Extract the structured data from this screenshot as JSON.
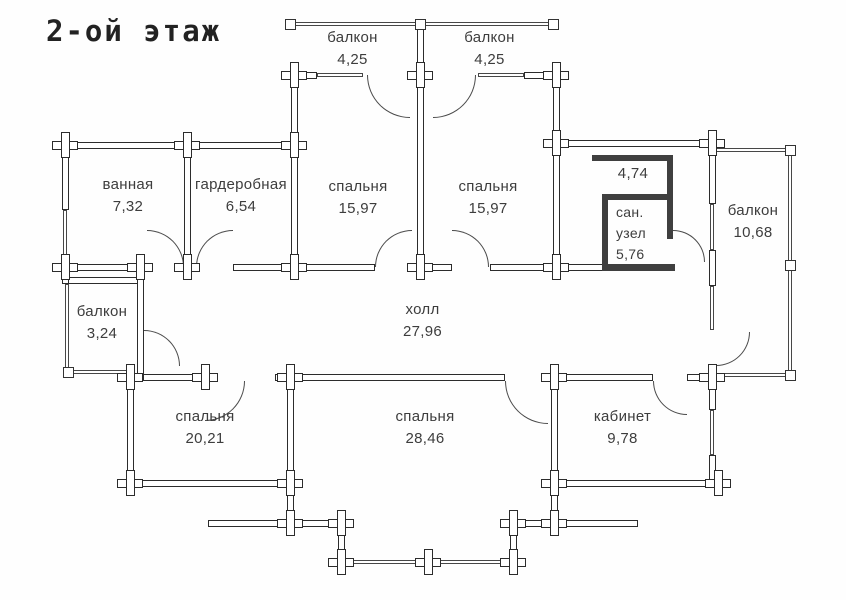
{
  "title": "2-ой этаж",
  "rooms": [
    {
      "id": "balcony-top-left",
      "name": "балкон",
      "area": "4,25"
    },
    {
      "id": "balcony-top-right",
      "name": "балкон",
      "area": "4,25"
    },
    {
      "id": "bathroom",
      "name": "ванная",
      "area": "7,32"
    },
    {
      "id": "wardrobe",
      "name": "гардеробная",
      "area": "6,54"
    },
    {
      "id": "bedroom-nw",
      "name": "спальня",
      "area": "15,97"
    },
    {
      "id": "bedroom-ne",
      "name": "спальня",
      "area": "15,97"
    },
    {
      "id": "lobby-small",
      "name": "",
      "area": "4,74"
    },
    {
      "id": "wc",
      "name": "сан. узел",
      "area": "5,76"
    },
    {
      "id": "balcony-east",
      "name": "балкон",
      "area": "10,68"
    },
    {
      "id": "balcony-west",
      "name": "балкон",
      "area": "3,24"
    },
    {
      "id": "hall",
      "name": "холл",
      "area": "27,96"
    },
    {
      "id": "bedroom-sw",
      "name": "спальня",
      "area": "20,21"
    },
    {
      "id": "bedroom-s",
      "name": "спальня",
      "area": "28,46"
    },
    {
      "id": "study",
      "name": "кабинет",
      "area": "9,78"
    }
  ],
  "colors": {
    "wall_outline": "#2c2c2c",
    "label_text": "#3d3d3d",
    "background": "#fefefe"
  }
}
